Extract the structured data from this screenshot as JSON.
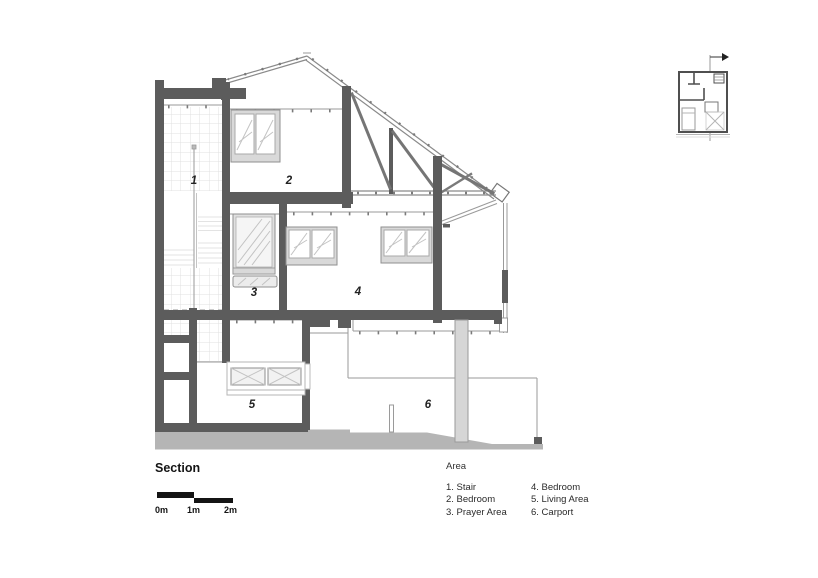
{
  "section": {
    "title": "Section",
    "labels": {
      "stair": "1",
      "bedroom_upper": "2",
      "prayer": "3",
      "bedroom_mid": "4",
      "living": "5",
      "carport": "6"
    }
  },
  "scalebar": {
    "m0": "0m",
    "m1": "1m",
    "m2": "2m"
  },
  "legend": {
    "title": "Area",
    "items_col1": [
      "1. Stair",
      "2. Bedroom",
      "3. Prayer Area"
    ],
    "items_col2": [
      "4. Bedroom",
      "5. Living Area",
      "6. Carport"
    ]
  },
  "colors": {
    "wall": "#5c5c5c",
    "line": "#9a9a9a",
    "ground": "#b5b5b5",
    "text": "#141414"
  }
}
